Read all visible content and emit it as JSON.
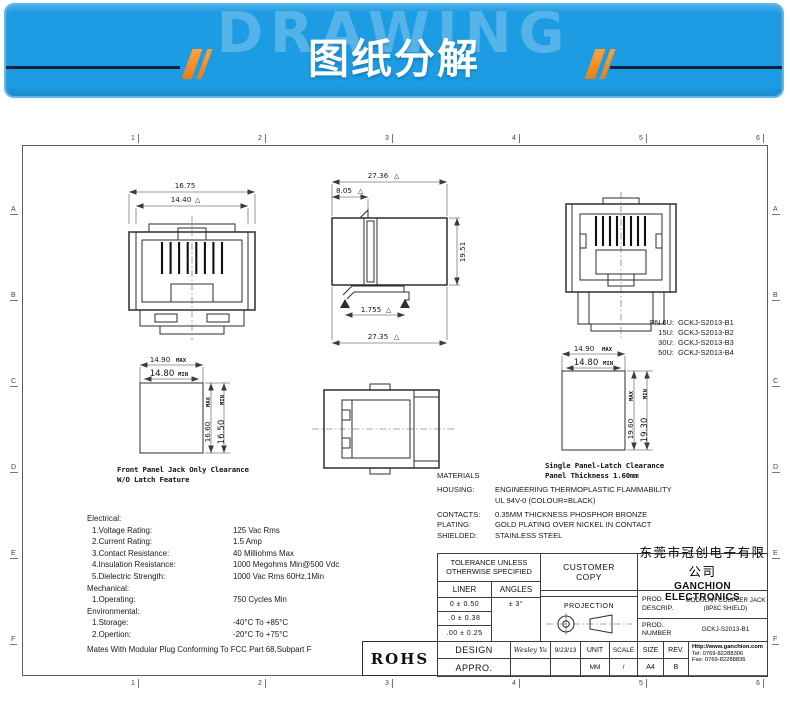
{
  "banner": {
    "watermark": "DRAWING",
    "title": "图纸分解"
  },
  "icons": {
    "flag": "△"
  },
  "grid": {
    "cols": [
      "1",
      "2",
      "3",
      "4",
      "5",
      "6"
    ],
    "rows": [
      "A",
      "B",
      "C",
      "D",
      "E",
      "F"
    ]
  },
  "views": {
    "front": {
      "dim_outer": "16.75",
      "dim_inner": "14.40"
    },
    "side": {
      "dim_top": "27.36",
      "dim_front": "8.05",
      "dim_height": "19.51",
      "dim_latch": "1.755",
      "dim_bottom": "27.35"
    }
  },
  "pn": {
    "rows": [
      {
        "label": "PN 6U:",
        "value": "GCKJ-S2013-B1"
      },
      {
        "label": "15U:",
        "value": "GCKJ-S2013-B2"
      },
      {
        "label": "30U:",
        "value": "GCKJ-S2013-B3"
      },
      {
        "label": "50U:",
        "value": "GCKJ-S2013-B4"
      }
    ]
  },
  "cutout_front": {
    "w_max": "14.90",
    "w_min": "14.80",
    "h_max": "16.60",
    "h_min": "16.50",
    "max_label": "MAX",
    "min_label": "MIN",
    "caption1": "Front Panel Jack Only Clearance",
    "caption2": "W/O Latch Feature"
  },
  "cutout_latch": {
    "w_max": "14.90",
    "w_min": "14.80",
    "h_max": "19.60",
    "h_min": "19.30",
    "max_label": "MAX",
    "min_label": "MIN",
    "caption1": "Single Panel-Latch Clearance",
    "caption2": "Panel Thickness 1.60mm"
  },
  "materials": {
    "heading": "MATERIALS",
    "rows": [
      {
        "label": "HOUSING:",
        "value": "ENGINEERING THERMOPLASTIC FLAMMABILITY",
        "value2": "UL 94V-0  (COLOUR=BLACK)"
      },
      {
        "label": "CONTACTS:",
        "value": "0.35MM THICKNESS PHOSPHOR BRONZE"
      },
      {
        "label": "PLATING:",
        "value": "GOLD PLATING OVER NICKEL IN CONTACT"
      },
      {
        "label": "SHIELDED:",
        "value": "STAINLESS  STEEL"
      }
    ]
  },
  "specs": {
    "rows": [
      {
        "label": "Electrical:",
        "value": ""
      },
      {
        "label": "1.Voltage Rating:",
        "value": "125 Vac Rms"
      },
      {
        "label": "2.Current Rating:",
        "value": "1.5 Amp"
      },
      {
        "label": "3.Contact Resistance:",
        "value": "40 Milliohms Max"
      },
      {
        "label": "4.Insulation Resistance:",
        "value": "1000 Megohms Min@500 Vdc"
      },
      {
        "label": "5.Dielectric Strength:",
        "value": "1000 Vac Rms 60Hz,1Min"
      },
      {
        "label": "Mechanical:",
        "value": ""
      },
      {
        "label": "1.Operating:",
        "value": "750 Cycles Min"
      },
      {
        "label": "Environmental:",
        "value": ""
      },
      {
        "label": "1.Storage:",
        "value": "-40°C To +85°C"
      },
      {
        "label": "2.Opertion:",
        "value": "-20°C To +75°C"
      }
    ],
    "footer": "Mates With Modular Plug Conforming To FCC Part 68,Subpart F"
  },
  "tb": {
    "tol_h1": "TOLERANCE UNLESS",
    "tol_h2": "OTHERWISE SPECIFIED",
    "liner": "LINER",
    "angles": "ANGLES",
    "tol_rows": [
      "0  ±  0.50",
      ".0  ±  0.38",
      ".00 ±  0.25"
    ],
    "angles_val": "±  3°",
    "customer1": "CUSTOMER",
    "customer2": "COPY",
    "projection": "PROJECTION",
    "design": "DESIGN",
    "design_name": "Wesley Yu",
    "design_date": "9/23/13",
    "appro": "APPRO.",
    "unit": "UNIT",
    "unit_v": "MM",
    "scale": "SCALE",
    "scale_v": "/",
    "size": "SIZE",
    "size_v": "A4",
    "rev": "REV.",
    "rev_v": "B",
    "company_cn": "东莞市冠创电子有限公司",
    "company_en": "GANCHION ELECTRONICS",
    "prod1a": "PROD.",
    "prod1b": "DESCRIP.",
    "descrip_v1": "MODULAR COUPLER JACK",
    "descrip_v2": "(8P8C SHIELD)",
    "prod2a": "PROD.",
    "prod2b": "NUMBER",
    "prod_number": "GCKJ-S2013-B1",
    "website": "Http://www.ganchion.com",
    "tel": "Tel:  0769-82288306",
    "fax": "Fax:  0769-82288836",
    "rohs": "ROHS"
  }
}
